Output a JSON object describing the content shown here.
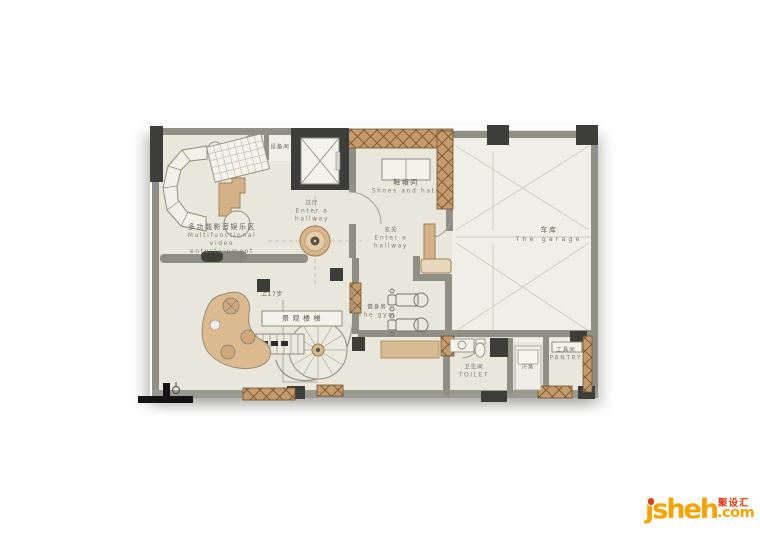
{
  "watermark": {
    "brand": "jsheh",
    "tld": ".com",
    "cn": "聚设汇",
    "orange": "#f8a300",
    "red": "#e8380d"
  },
  "plan": {
    "colors": {
      "room_fill": "#e9e7db",
      "garage_fill": "#f0efe7",
      "wall_gray": "#8f8f85",
      "column_dark": "#3d3d39",
      "wood_hatch": "#c59a6c",
      "furniture_tan": "#d4b189",
      "label_text": "#7b7b6e"
    },
    "rooms": {
      "equipment": {
        "cn": "设备间"
      },
      "entertainment": {
        "cn": "多功能影音娱乐区",
        "en_line1": "Multifunctional",
        "en_line2": "video",
        "en_line3": "entertainment"
      },
      "hallway": {
        "cn": "过厅",
        "en_line1": "Enter a",
        "en_line2": "hallway"
      },
      "entrance": {
        "cn": "玄关",
        "en_line1": "Enter a",
        "en_line2": "hallway"
      },
      "shoes": {
        "cn": "鞋帽间",
        "en": "Shoes and hats"
      },
      "garage": {
        "cn": "车库",
        "en": "The garage"
      },
      "gym": {
        "cn": "健身房",
        "en": "The gym"
      },
      "stairs": {
        "steps_note": "上17步",
        "label": "景观楼梯"
      },
      "toilet": {
        "cn": "卫生间",
        "en": "TOILET"
      },
      "sauna": {
        "cn": "汗蒸"
      },
      "pantry": {
        "cn": "工具间",
        "en": "PANTRY"
      }
    }
  }
}
